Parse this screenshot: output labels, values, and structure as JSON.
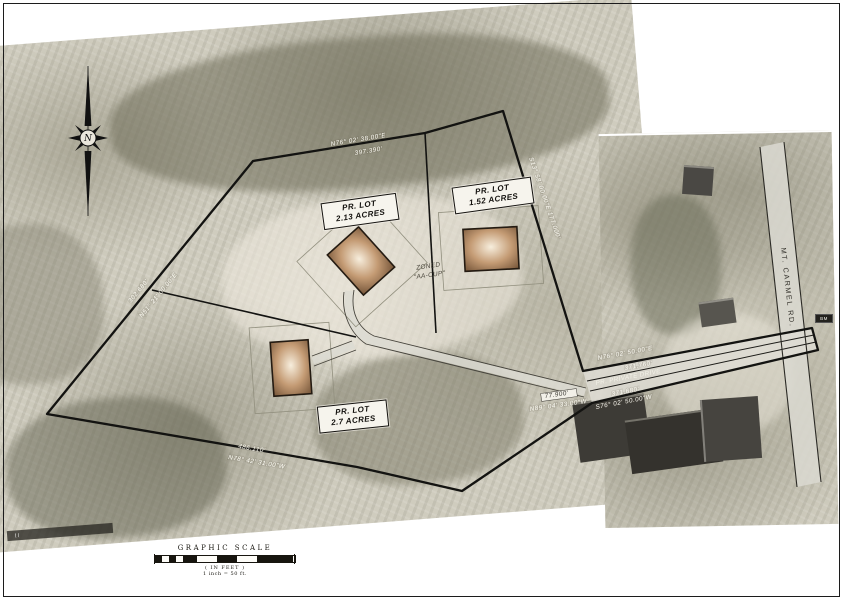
{
  "compass": {
    "label": "N"
  },
  "lots": [
    {
      "line1": "PR. LOT",
      "line2": "2.13 ACRES"
    },
    {
      "line1": "PR. LOT",
      "line2": "1.52 ACRES"
    },
    {
      "line1": "PR. LOT",
      "line2": "2.7 ACRES"
    }
  ],
  "zoning": {
    "line1": "ZONED",
    "line2": "\"AA-CUP\""
  },
  "roads": {
    "mt_carmel": "MT. CARMEL RD.",
    "private_drive": "PR. PRIVATE DRIVE"
  },
  "bearings": {
    "north_line_bearing": "N76° 02' 38.00\"E",
    "north_line_distance": "397.390'",
    "west_line_distance": "302.680'",
    "west_line_bearing": "N51° 21' 00.00\"E",
    "south_line_distance": "486.110'",
    "south_line_bearing": "N78° 42' 31.00\"W",
    "drive_north_bearing": "N76° 02' 50.00\"E",
    "drive_north_distance": "371.760'",
    "drive_south_distance": "371.680'",
    "drive_south_bearing": "S76° 02' 50.00\"W",
    "stub_distance": "77.900'",
    "stub_bearing": "N89° 04' 33.00\"W",
    "east_lot_line": "S13° 58' 00.00\"E  177.000'"
  },
  "benchmark": {
    "label": "BM"
  },
  "scale": {
    "title": "GRAPHIC SCALE",
    "units": "( IN FEET )",
    "ratio": "1 inch = 50  ft."
  }
}
